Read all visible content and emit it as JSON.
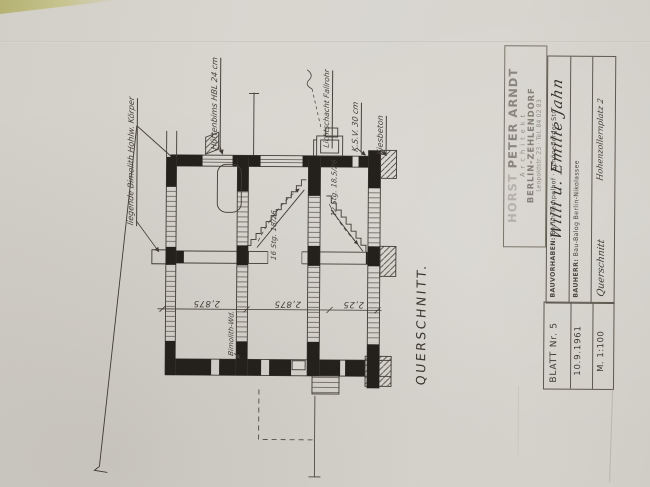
{
  "colors": {
    "paper": "#d7d4ce",
    "ink": "#3f3b34",
    "black_fill": "#24211c",
    "handwriting": "#45413a",
    "stamp_ink": "#716c62",
    "desk_corner": "#b9b574"
  },
  "drawing": {
    "title": "QUERSCHNITT.",
    "annotations": {
      "liegende": "liegende Bimolith Hohlw. Körper",
      "huettenbims": "Hüttenbims HBL 24 cm",
      "lichtschacht": "Lichtschacht Fallrohr",
      "ksv": "K.S.V. 30 cm",
      "kiesbeton": "Kiesbeton",
      "bimolith_wand": "Bimolith-Wd.",
      "stair_left": "16 Stg. 18/26",
      "stair_right": "12 Stg. 18,5/26"
    },
    "dimensions": {
      "storey_top": "2,875",
      "storey_middle": "2,875",
      "storey_bottom": "2,25"
    }
  },
  "title_block": {
    "stamp": {
      "name_prefix": "HORST ",
      "name": "PETER ARNDT",
      "profession": "A r c h i t e k t",
      "city": "BERLIN-ZEHLENDORF",
      "address": "Leopoldstr. 23 · Tel. 84 02 83"
    },
    "project_label": "BAUVORHABEN: ",
    "project_value": "Berlin-Tempelhof · Schöneberger Str.",
    "project_handwritten": "Willi u. Emilie Jahn",
    "client_label": "BAUHERR: ",
    "client_value": "Bau-Balog Berlin-Nikolassee",
    "client_handwritten": "Hohenzollernplatz 2",
    "drawing_title_handwritten": "Querschnitt",
    "sheet_number": "BLATT Nr. 5",
    "date": "10.9.1961",
    "scale": "M. 1:100"
  }
}
